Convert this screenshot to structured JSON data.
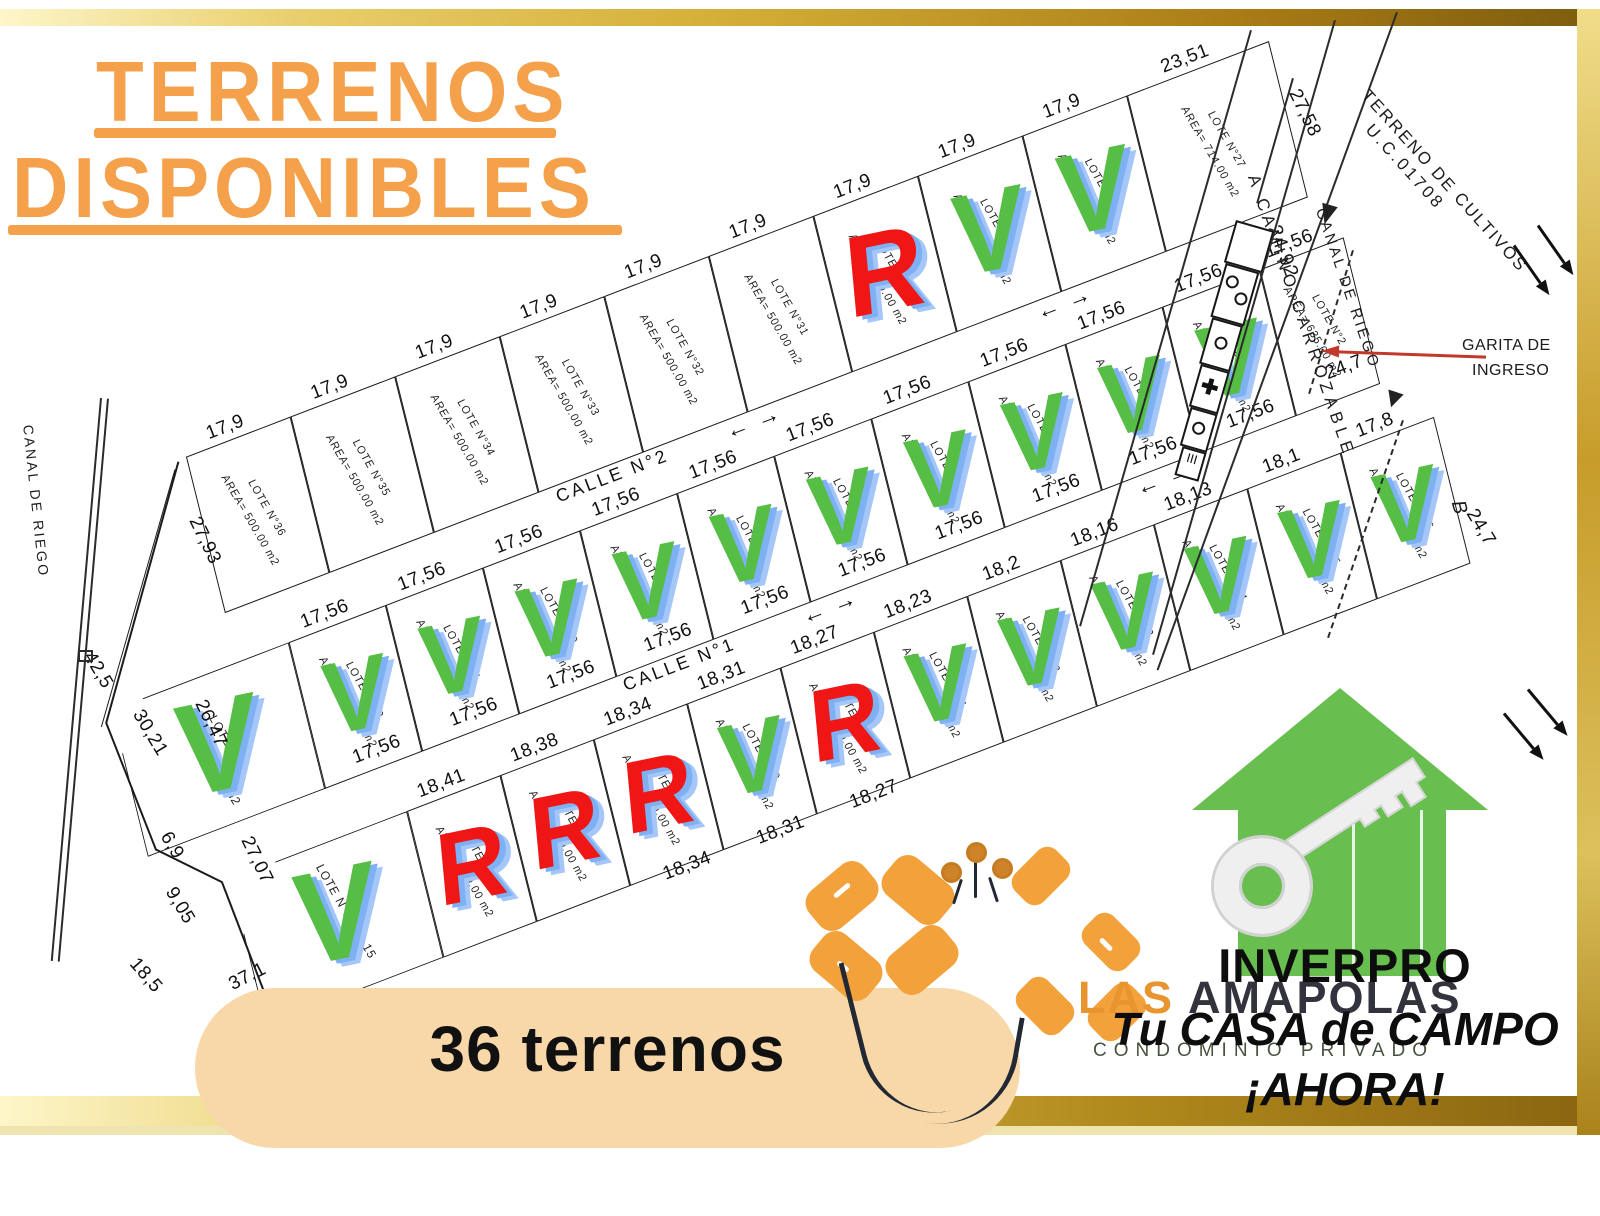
{
  "title": {
    "line1": "TERRENOS",
    "line2": "DISPONIBLES"
  },
  "footer": {
    "count_label": "36 terrenos"
  },
  "brand": {
    "name_accent": "LAS",
    "name_rest": "AMAPOLAS",
    "subtitle": "CONDOMINIO PRIVADO"
  },
  "promo": {
    "company": "INVERPRO",
    "line1": "Tu CASA de CAMPO",
    "line2": "¡AHORA!"
  },
  "legend": {
    "available_char": "V",
    "reserved_char": "R"
  },
  "annotations": {
    "canal_left": "CANAL DE RIEGO",
    "canal_right": "CANAL DE RIEGO",
    "road": "A  CAMINO CARROZABLE",
    "terreno_line1": "TERRENO DE CULTIVOS",
    "terreno_line2": "U.C.01708",
    "garita_line1": "GARITA DE",
    "garita_line2": "INGRESO",
    "road_dim": "24,92",
    "point_b": "B"
  },
  "map": {
    "streets": [
      {
        "label": "CALLE N°2",
        "lx": 660,
        "ly": 281,
        "arrows": [
          [
            815,
            281
          ],
          [
            1148,
            281
          ]
        ]
      },
      {
        "label": "CALLE N°1",
        "lx": 655,
        "ly": 481,
        "arrows": [
          [
            820,
            481
          ],
          [
            1178,
            481
          ]
        ]
      }
    ],
    "rows": [
      {
        "id": "top",
        "y": 110,
        "h": 160,
        "big": false,
        "cls": "rowtop",
        "lots": [
          {
            "n": "LOTE N°36",
            "a": "AREA= 500.00  m2",
            "x": 260,
            "w": 112,
            "d": "17,9",
            "m": null
          },
          {
            "n": "LOTE N°35",
            "a": "AREA= 500.00  m2",
            "x": 372,
            "w": 112,
            "d": "17,9",
            "m": null
          },
          {
            "n": "LOTE N°34",
            "a": "AREA= 500.00  m2",
            "x": 484,
            "w": 112,
            "d": "17,9",
            "m": null
          },
          {
            "n": "LOTE N°33",
            "a": "AREA= 500.00  m2",
            "x": 596,
            "w": 112,
            "d": "17,9",
            "m": null
          },
          {
            "n": "LOTE N°32",
            "a": "AREA= 500.00  m2",
            "x": 708,
            "w": 112,
            "d": "17,9",
            "m": null
          },
          {
            "n": "LOTE N°31",
            "a": "AREA= 500.00  m2",
            "x": 820,
            "w": 112,
            "d": "17,9",
            "m": null
          },
          {
            "n": "LOTE N°30",
            "a": "AREA= 500.00  m2",
            "x": 932,
            "w": 112,
            "d": "17,9",
            "m": "R"
          },
          {
            "n": "LOTE N°29",
            "a": "AREA= 500.00  m2",
            "x": 1044,
            "w": 112,
            "d": "17,9",
            "m": "V"
          },
          {
            "n": "LOTE N°28",
            "a": "AREA= 500.00  m2",
            "x": 1156,
            "w": 112,
            "d": "17,9",
            "m": "V"
          },
          {
            "n": "LOTE N°27",
            "a": "AREA= 714.00  m2",
            "x": 1268,
            "w": 152,
            "d": "23,51",
            "m": null
          }
        ]
      },
      {
        "id": "middle",
        "y": 320,
        "h": 150,
        "big": false,
        "cls": "rowmid",
        "lots": [
          {
            "n": "LOTE N°1",
            "a": "AREA= 823.00  m2",
            "x": 100,
            "w": 190,
            "d": null,
            "m": "V",
            "big": true,
            "clip": "clip-tl2"
          },
          {
            "n": "LOTE N°12",
            "a": "AREA= 500.00  m2",
            "x": 290,
            "w": 104,
            "d": "17,56",
            "m": "V"
          },
          {
            "n": "LOTE N°11",
            "a": "AREA= 500.00  m2",
            "x": 394,
            "w": 104,
            "d": "17,56",
            "m": "V"
          },
          {
            "n": "LOTE N°10",
            "a": "AREA= 500.00  m2",
            "x": 498,
            "w": 104,
            "d": "17,56",
            "m": "V"
          },
          {
            "n": "LOTE N°9",
            "a": "AREA= 500.00  m2",
            "x": 602,
            "w": 104,
            "d": "17,56",
            "m": "V"
          },
          {
            "n": "LOTE N°8",
            "a": "AREA= 500.00  m2",
            "x": 706,
            "w": 104,
            "d": "17,56",
            "m": "V"
          },
          {
            "n": "LOTE N°7",
            "a": "AREA= 500.00  m2",
            "x": 810,
            "w": 104,
            "d": "17,56",
            "m": "V"
          },
          {
            "n": "LOTE N°6",
            "a": "AREA= 500.00  m2",
            "x": 914,
            "w": 104,
            "d": "17,56",
            "m": "V"
          },
          {
            "n": "LOTE N°5",
            "a": "AREA= 500.00  m2",
            "x": 1018,
            "w": 104,
            "d": "17,56",
            "m": "V"
          },
          {
            "n": "LOTE N°4",
            "a": "AREA= 500.00  m2",
            "x": 1122,
            "w": 104,
            "d": "17,56",
            "m": "V"
          },
          {
            "n": "LOTE N°3",
            "a": "AREA= 500.00  m2",
            "x": 1226,
            "w": 104,
            "d": "17,56",
            "m": "V"
          },
          {
            "n": "LOTE N°2",
            "a": "AREA= 635.00  m2",
            "x": 1330,
            "w": 90,
            "d": "17,56",
            "m": null
          }
        ]
      },
      {
        "id": "bottom",
        "y": 520,
        "h": 150,
        "big": false,
        "cls": "rowbot",
        "lots": [
          {
            "n": "LOTE N°13,14,15",
            "a": "AREA=",
            "x": 150,
            "w": 190,
            "d": null,
            "m": "V",
            "big": true,
            "clip": "clip-tl"
          },
          {
            "n": "LOTE N°16",
            "a": "AREA= 500.00  m2",
            "x": 340,
            "w": 100,
            "d": "18,41",
            "m": "R"
          },
          {
            "n": "LOTE N°17",
            "a": "AREA= 500.00  m2",
            "x": 440,
            "w": 100,
            "d": "18,38",
            "m": "R"
          },
          {
            "n": "LOTE N°18",
            "a": "AREA= 500.00  m2",
            "x": 540,
            "w": 100,
            "d": "18,34",
            "m": "R"
          },
          {
            "n": "LOTE N°19",
            "a": "AREA= 500.00  m2",
            "x": 640,
            "w": 100,
            "d": "18,31",
            "m": "V"
          },
          {
            "n": "LOTE N°20",
            "a": "AREA= 500.00  m2",
            "x": 740,
            "w": 100,
            "d": "18,27",
            "m": "R"
          },
          {
            "n": "LOTE N°21",
            "a": "AREA= 500.00  m2",
            "x": 840,
            "w": 100,
            "d": "18,23",
            "m": "V"
          },
          {
            "n": "LOTE N°22",
            "a": "AREA= 500.00  m2",
            "x": 940,
            "w": 100,
            "d": "18,2",
            "m": "V"
          },
          {
            "n": "LOTE N°23",
            "a": "AREA= 500.00  m2",
            "x": 1040,
            "w": 100,
            "d": "18,16",
            "m": "V"
          },
          {
            "n": "LOTE N°24",
            "a": "AREA= 500.00  m2",
            "x": 1140,
            "w": 100,
            "d": "18,13",
            "m": "V"
          },
          {
            "n": "LOTE N°25",
            "a": "AREA= 500.00  m2",
            "x": 1240,
            "w": 100,
            "d": "18,1",
            "m": "V"
          },
          {
            "n": "LOTE N°26",
            "a": "AREA= 500.00  m2",
            "x": 1340,
            "w": 100,
            "d": "17,8",
            "m": "V"
          }
        ]
      }
    ],
    "edge_dims": [
      {
        "t": "27,93",
        "x": 256,
        "y": 195,
        "r": 85
      },
      {
        "t": "27,58",
        "x": 1436,
        "y": 190,
        "r": 85
      },
      {
        "t": "42,5",
        "x": 110,
        "y": 278,
        "r": 80
      },
      {
        "t": "30,21",
        "x": 136,
        "y": 355,
        "r": 80
      },
      {
        "t": "26,47",
        "x": 196,
        "y": 368,
        "r": 85
      },
      {
        "t": "6,9",
        "x": 116,
        "y": 468,
        "r": 80
      },
      {
        "t": "9,05",
        "x": 102,
        "y": 527,
        "r": 80
      },
      {
        "t": "18,5",
        "x": 45,
        "y": 580,
        "r": 70
      },
      {
        "t": "27,07",
        "x": 190,
        "y": 512,
        "r": 85
      },
      {
        "t": "37,1",
        "x": 140,
        "y": 618,
        "r": -6
      },
      {
        "t": "24,7",
        "x": 1382,
        "y": 442,
        "r": 0
      },
      {
        "t": "24,7",
        "x": 1452,
        "y": 640,
        "r": 80
      },
      {
        "t": "17,56",
        "x": 342,
        "y": 452,
        "r": 0
      },
      {
        "t": "17,56",
        "x": 446,
        "y": 452,
        "r": 0
      },
      {
        "t": "17,56",
        "x": 550,
        "y": 452,
        "r": 0
      },
      {
        "t": "17,56",
        "x": 654,
        "y": 452,
        "r": 0
      },
      {
        "t": "17,56",
        "x": 758,
        "y": 452,
        "r": 0
      },
      {
        "t": "17,56",
        "x": 862,
        "y": 452,
        "r": 0
      },
      {
        "t": "17,56",
        "x": 966,
        "y": 452,
        "r": 0
      },
      {
        "t": "17,56",
        "x": 1070,
        "y": 452,
        "r": 0
      },
      {
        "t": "17,56",
        "x": 1174,
        "y": 452,
        "r": 0
      },
      {
        "t": "17,56",
        "x": 1278,
        "y": 452,
        "r": 0
      },
      {
        "t": "18,34",
        "x": 590,
        "y": 672,
        "r": 0
      },
      {
        "t": "18,31",
        "x": 690,
        "y": 672,
        "r": 0
      },
      {
        "t": "18,27",
        "x": 790,
        "y": 672,
        "r": 0
      }
    ]
  }
}
